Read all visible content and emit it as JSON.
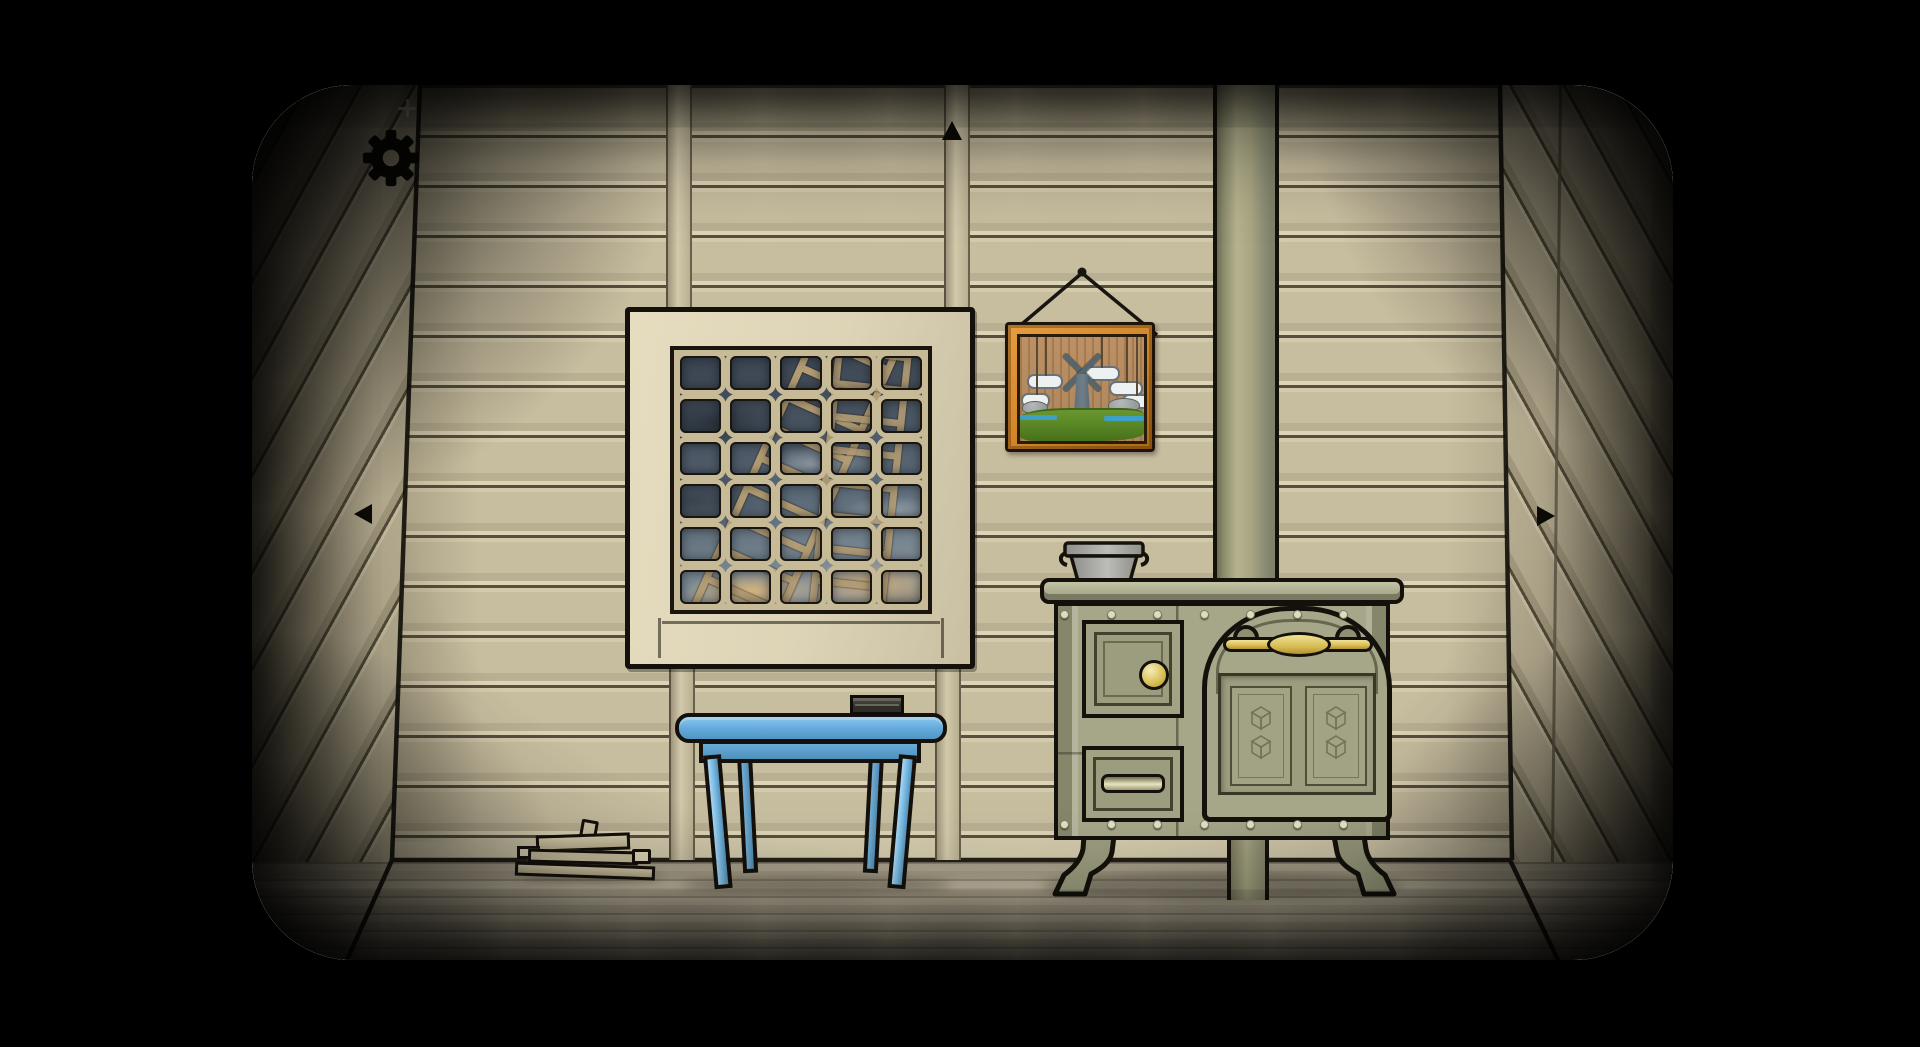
{
  "scene": {
    "name": "cabin-room",
    "objects": [
      "settings-gear",
      "nav-up",
      "nav-left",
      "nav-right",
      "window",
      "framed-picture",
      "chimney-pipe",
      "cooking-pot",
      "wood-stove",
      "table",
      "matchbox",
      "firewood-pile"
    ]
  },
  "hud": {
    "settings_icon": "gear-icon",
    "nav_up_icon": "up-arrow-icon",
    "nav_left_icon": "left-arrow-icon",
    "nav_right_icon": "right-arrow-icon"
  },
  "window": {
    "cols": 5,
    "rows": 6,
    "view": "cloudy sky with leaning ladders"
  },
  "picture": {
    "clouds": 5,
    "motifs": [
      "windmill",
      "hanging-clouds",
      "grass",
      "water",
      "rocks"
    ]
  },
  "stove": {
    "rivets_top": 7,
    "rivets_bottom": 7,
    "cube_motifs_per_panel": 2,
    "parts": [
      "small-door",
      "knob",
      "drawer",
      "oven-door",
      "handle",
      "legs"
    ]
  },
  "theme": {
    "line": "#14110c",
    "wall": "#c7bd9f",
    "wall-seam": "#55503c",
    "floor": "#b5ac95",
    "floor-line": "#9c937d",
    "frame-cream": "#ddd3b6",
    "mullion": "#c6ba97",
    "sky-dark": "#39434f",
    "sky-light": "#8e99a2",
    "ladder": "#b29c74",
    "pic-orange": "#cf8428",
    "pic-orange-dark": "#a96a16",
    "pic-tan": "#bb9064",
    "grass": "#5c8a26",
    "water": "#3da0c4",
    "cloud": "#eef1f2",
    "mill": "#6e7f88",
    "pipe": "#a9a783",
    "pipe-dark": "#6c6c52",
    "stove": "#a6a789",
    "stove-panel": "#9c9d7f",
    "brass": "#d8bd55",
    "brass-light": "#f0e195",
    "pot": "#a8a8a4",
    "table-blue": "#62a9da",
    "table-light": "#8ac7ec",
    "table-dark": "#4f8cb4",
    "log": "#cdc2a2"
  }
}
